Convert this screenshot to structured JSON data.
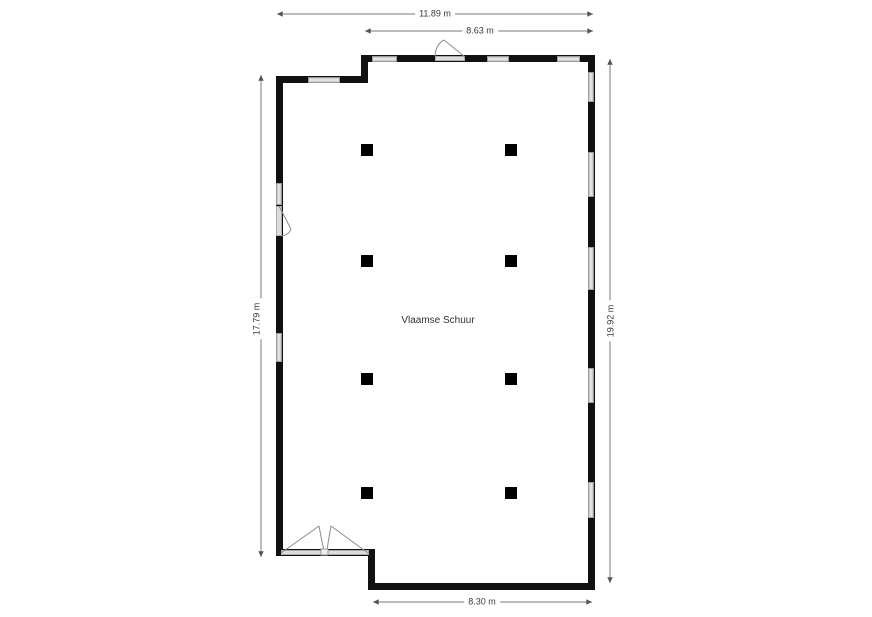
{
  "floorplan": {
    "room_label": "Vlaamse Schuur",
    "dimensions": {
      "top_outer": "11.89 m",
      "top_inner": "8.63 m",
      "left": "17.79 m",
      "right": "19.92 m",
      "bottom": "8.30 m"
    },
    "counts": {
      "columns": 8,
      "windows": 11,
      "doors": 3
    },
    "colors": {
      "wall": "#111111",
      "window_fill": "#cfcfcf",
      "window_border": "#9a9a9a",
      "door_sill": "#dcdcdc",
      "door_arc": "#8c8c8c",
      "dimension_line": "#7a7a7a",
      "dimension_arrow": "#555555",
      "dimension_text": "#3a3a3a",
      "column": "#000000",
      "background": "#ffffff"
    }
  }
}
